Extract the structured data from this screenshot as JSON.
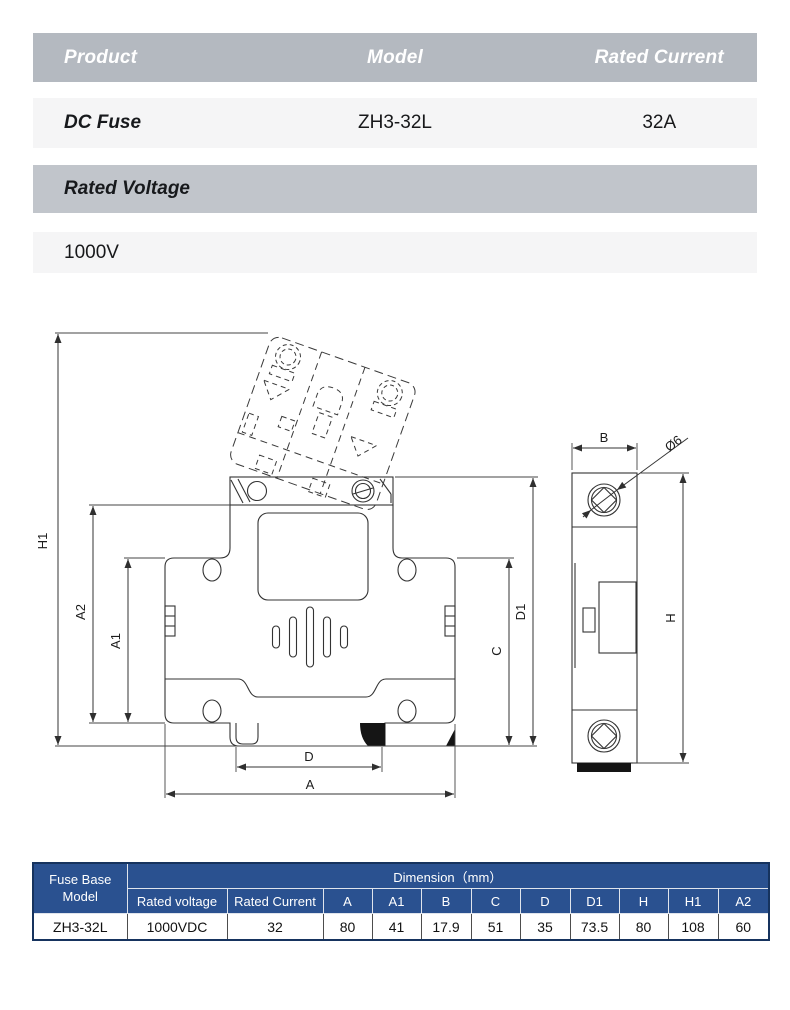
{
  "spec_table": {
    "headers": {
      "product": "Product",
      "model": "Model",
      "rated_current": "Rated Current"
    },
    "row": {
      "product": "DC Fuse",
      "model": "ZH3-32L",
      "rated_current": "32A"
    },
    "voltage_header": "Rated Voltage",
    "voltage_value": "1000V"
  },
  "drawing": {
    "labels": {
      "h1": "H1",
      "a2": "A2",
      "a1": "A1",
      "d": "D",
      "a": "A",
      "c": "C",
      "d1": "D1",
      "b": "B",
      "diameter": "Ø6",
      "h": "H"
    }
  },
  "dimension_table": {
    "corner_header": "Fuse Base Model",
    "group_header": "Dimension（mm）",
    "sub_headers": [
      "Rated voltage",
      "Rated Current",
      "A",
      "A1",
      "B",
      "C",
      "D",
      "D1",
      "H",
      "H1",
      "A2"
    ],
    "rows": [
      [
        "ZH3-32L",
        "1000VDC",
        "32",
        "80",
        "41",
        "17.9",
        "51",
        "35",
        "73.5",
        "80",
        "108",
        "60"
      ]
    ]
  },
  "colors": {
    "table_header_blue": "#2a5190",
    "table_border_navy": "#16335e",
    "band_gray": "#b4b9c0",
    "band_gray_light": "#c1c5cb",
    "row_bg": "#f5f5f6",
    "line": "#333333"
  }
}
